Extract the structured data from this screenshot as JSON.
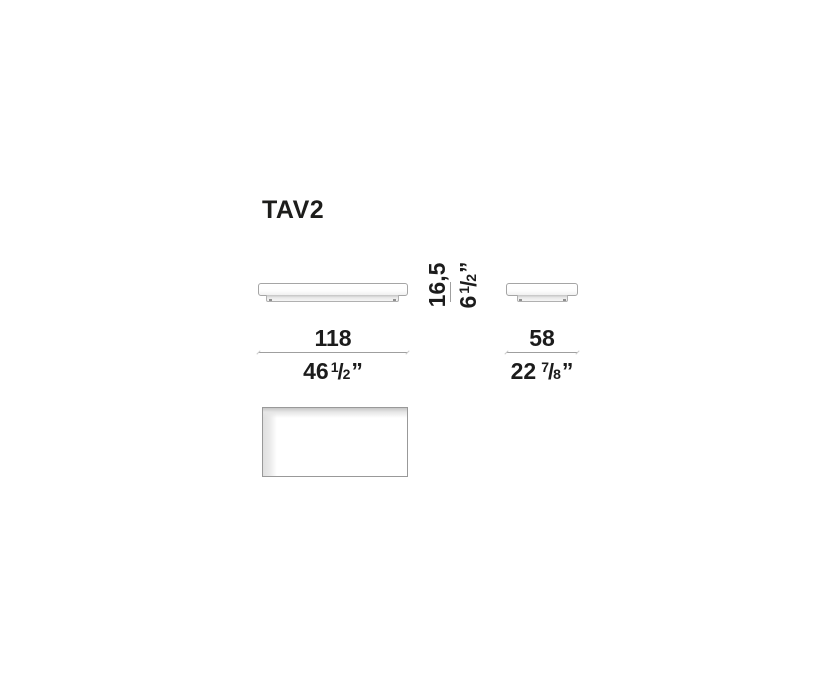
{
  "title": "TAV2",
  "notation": {
    "slash": "/",
    "inch_mark": "”"
  },
  "dimensions": {
    "width": {
      "cm": "118",
      "in_whole": "46",
      "in_num": "1",
      "in_den": "2"
    },
    "depth": {
      "cm": "58",
      "in_whole": "22",
      "in_num": "7",
      "in_den": "8"
    },
    "height": {
      "cm": "16,5",
      "in_whole": "6",
      "in_num": "1",
      "in_den": "2"
    }
  },
  "views": {
    "front": "front-elevation",
    "side": "side-elevation",
    "top": "top-plan"
  },
  "colors": {
    "text": "#1c1c1c",
    "dimension_line": "#9f9f9f",
    "outline": "#a5a5a5",
    "background": "#ffffff"
  }
}
